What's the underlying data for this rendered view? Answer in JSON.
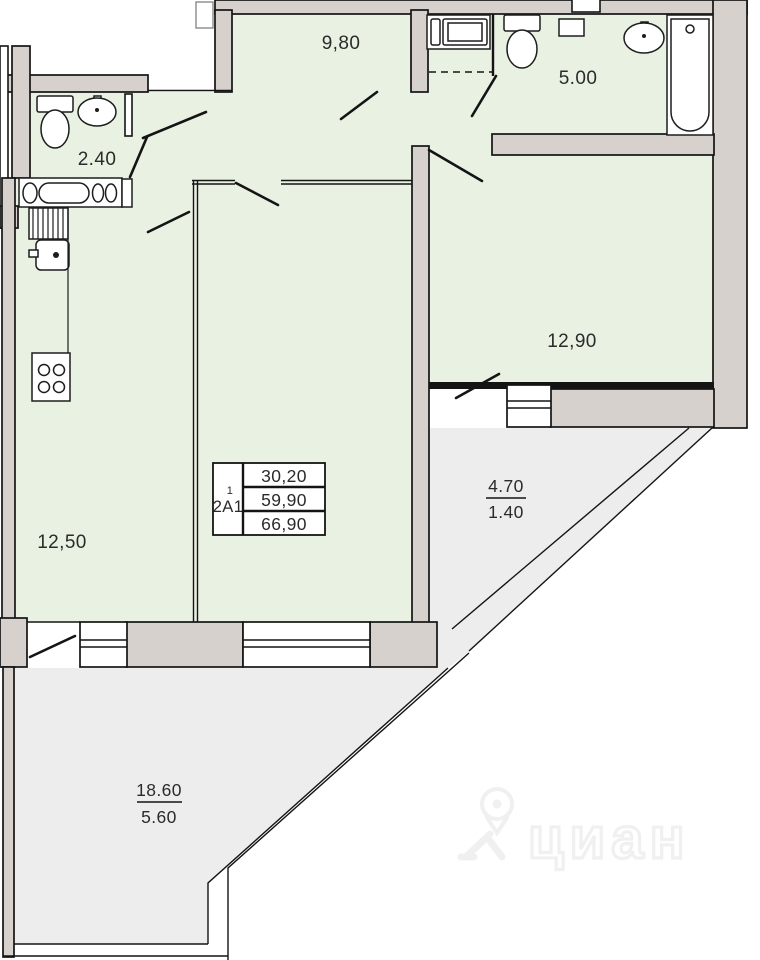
{
  "rooms": {
    "hallway": "9,80",
    "bathroom": "5.00",
    "wc": "2.40",
    "bedroom": "12,90",
    "kitchen": "12,50",
    "balcony_total": "4.70",
    "balcony_reduced": "1.40",
    "terrace_total": "18.60",
    "terrace_reduced": "5.60"
  },
  "info_table": {
    "unit": "2А1",
    "sup": "1",
    "rows": [
      "30,20",
      "59,90",
      "66,90"
    ]
  },
  "watermark": {
    "logo_text": "циан"
  },
  "colors": {
    "room_fill": "#e9f1e3",
    "balcony_fill": "#ededee",
    "wall_fill": "#d7d1cd",
    "outline": "#141414",
    "label": "#2b2b2b",
    "watermark": "#f0f0f0"
  }
}
